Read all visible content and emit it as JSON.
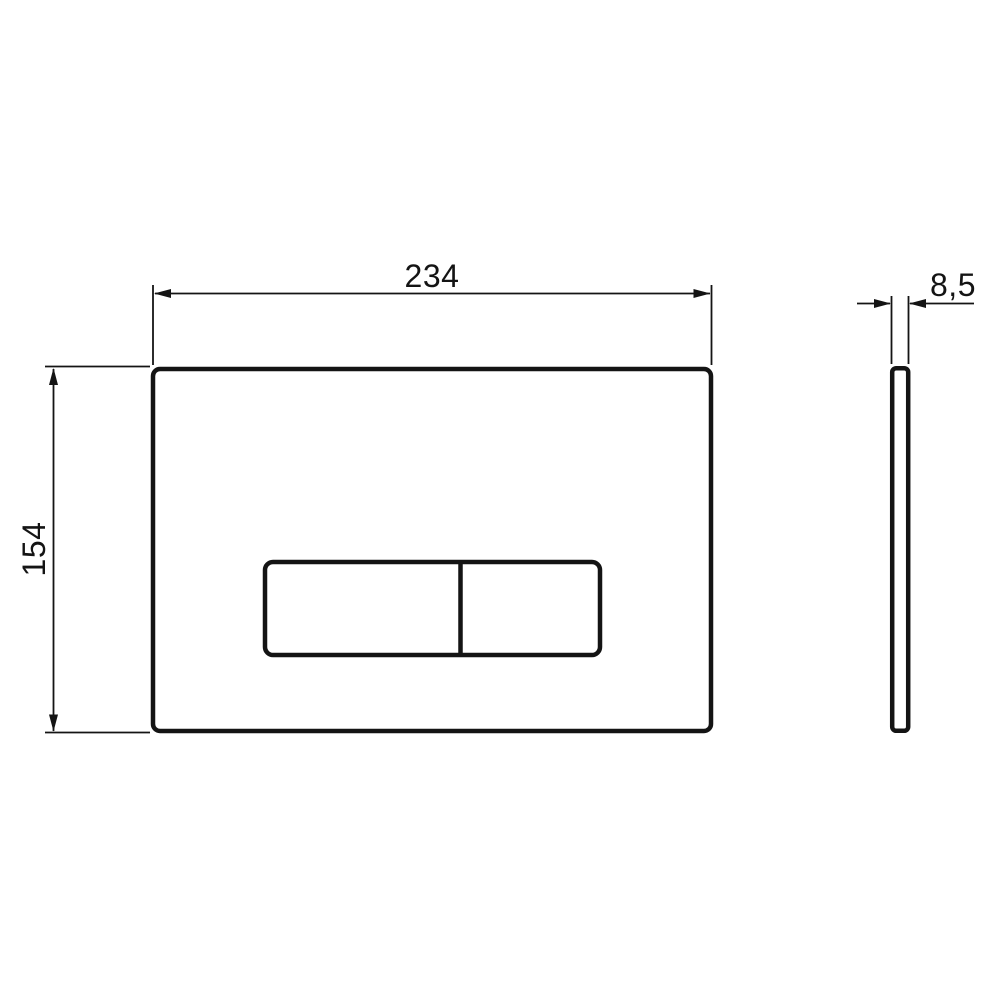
{
  "diagram": {
    "description": "Technical dimension drawing of a rectangular dual-button flush plate, front view and side (thickness) view",
    "dimension_labels": {
      "width": "234",
      "thickness": "8,5",
      "height": "154"
    },
    "colors": {
      "line": "#141414",
      "background": "#ffffff"
    }
  }
}
